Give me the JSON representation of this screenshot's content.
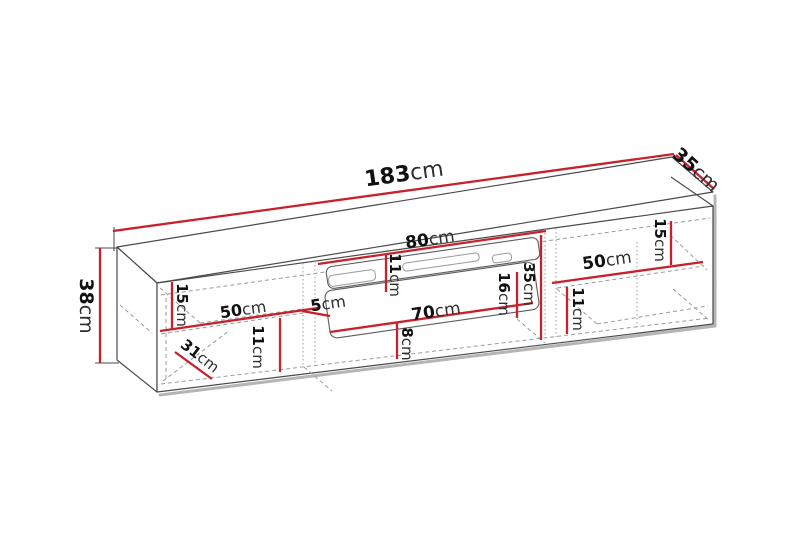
{
  "diagram": {
    "kind": "furniture-dimension-diagram",
    "unit": "cm",
    "colors": {
      "background": "#ffffff",
      "dimension_line": "#c9212c",
      "outline": "#4a4a4a",
      "hidden_edge": "#9b9b9b",
      "shadow": "#b5b5b5",
      "label_number": "#111111",
      "label_unit": "#2e2e2e"
    },
    "dimensions": [
      {
        "id": "overall-width",
        "value": "183",
        "unit": "cm"
      },
      {
        "id": "overall-depth",
        "value": "35",
        "unit": "cm"
      },
      {
        "id": "overall-height",
        "value": "38",
        "unit": "cm"
      },
      {
        "id": "left-top-shelf-height",
        "value": "15",
        "unit": "cm"
      },
      {
        "id": "left-shelf-width",
        "value": "50",
        "unit": "cm"
      },
      {
        "id": "center-gap",
        "value": "5",
        "unit": "cm"
      },
      {
        "id": "left-lower-shelf-height",
        "value": "11",
        "unit": "cm"
      },
      {
        "id": "inner-depth",
        "value": "31",
        "unit": "cm"
      },
      {
        "id": "fireplace-opening-width",
        "value": "80",
        "unit": "cm"
      },
      {
        "id": "fireplace-top-height",
        "value": "11",
        "unit": "cm"
      },
      {
        "id": "fireplace-panel-width",
        "value": "70",
        "unit": "cm"
      },
      {
        "id": "fireplace-bottom-height",
        "value": "8",
        "unit": "cm"
      },
      {
        "id": "fireplace-insert-height",
        "value": "16",
        "unit": "cm"
      },
      {
        "id": "middle-inner-height",
        "value": "35",
        "unit": "cm"
      },
      {
        "id": "right-shelf-width",
        "value": "50",
        "unit": "cm"
      },
      {
        "id": "right-top-shelf-height",
        "value": "15",
        "unit": "cm"
      },
      {
        "id": "right-lower-shelf-height",
        "value": "11",
        "unit": "cm"
      }
    ]
  }
}
